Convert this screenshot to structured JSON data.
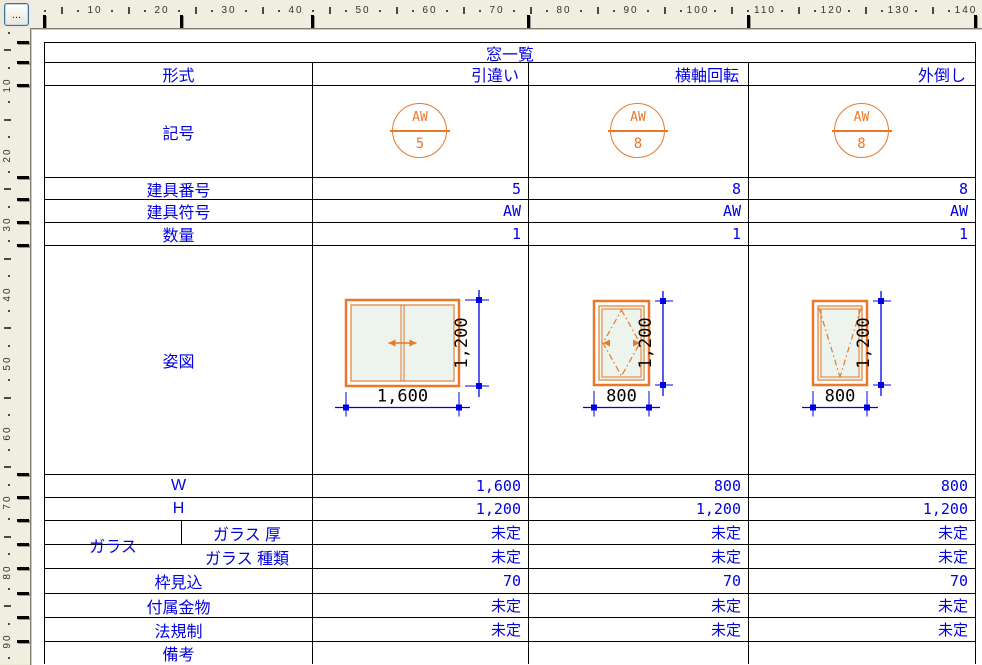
{
  "corner_button": {
    "label": "..."
  },
  "rulers": {
    "top_numbers": [
      "10",
      "20",
      "30",
      "40",
      "50",
      "60",
      "70",
      "80",
      "90",
      "100",
      "110",
      "120",
      "130",
      "140"
    ],
    "left_numbers": [
      "10",
      "20",
      "30",
      "40",
      "50",
      "60",
      "70",
      "80",
      "90"
    ]
  },
  "colors": {
    "text_blue": "#0202dd",
    "dimension_blue": "#0000e0",
    "frame_orange": "#e8782a",
    "glass_fill": "#edf3ed",
    "table_line": "#000000",
    "dimension_text": "#000000"
  },
  "table": {
    "title": "窓一覧",
    "type_row_label": "形式",
    "type_values": [
      "引違い",
      "横軸回転",
      "外倒し"
    ],
    "symbol_row_label": "記号",
    "symbols": [
      {
        "code": "AW",
        "number": "5"
      },
      {
        "code": "AW",
        "number": "8"
      },
      {
        "code": "AW",
        "number": "8"
      }
    ],
    "info_rows": [
      {
        "label": "建具番号",
        "values": [
          "5",
          "8",
          "8"
        ]
      },
      {
        "label": "建具符号",
        "values": [
          "AW",
          "AW",
          "AW"
        ]
      },
      {
        "label": "数量",
        "values": [
          "1",
          "1",
          "1"
        ]
      }
    ],
    "figure_row_label": "姿図",
    "figures": [
      {
        "style": "sliding",
        "width_label": "1,600",
        "height_label": "1,200"
      },
      {
        "style": "horizontal-pivot",
        "width_label": "800",
        "height_label": "1,200"
      },
      {
        "style": "tilt-out",
        "width_label": "800",
        "height_label": "1,200"
      }
    ],
    "glass_group_label": "ガラス",
    "lower_rows": [
      {
        "label": "W",
        "group": false,
        "values": [
          "1,600",
          "800",
          "800"
        ]
      },
      {
        "label": "H",
        "group": false,
        "values": [
          "1,200",
          "1,200",
          "1,200"
        ]
      },
      {
        "label": "ガラス 厚",
        "group": true,
        "values": [
          "未定",
          "未定",
          "未定"
        ]
      },
      {
        "label": "ガラス 種類",
        "group": true,
        "values": [
          "未定",
          "未定",
          "未定"
        ]
      },
      {
        "label": "枠見込",
        "group": false,
        "values": [
          "70",
          "70",
          "70"
        ]
      },
      {
        "label": "付属金物",
        "group": false,
        "values": [
          "未定",
          "未定",
          "未定"
        ]
      },
      {
        "label": "法規制",
        "group": false,
        "values": [
          "未定",
          "未定",
          "未定"
        ]
      },
      {
        "label": "備考",
        "group": false,
        "values": [
          "",
          "",
          ""
        ]
      }
    ]
  }
}
